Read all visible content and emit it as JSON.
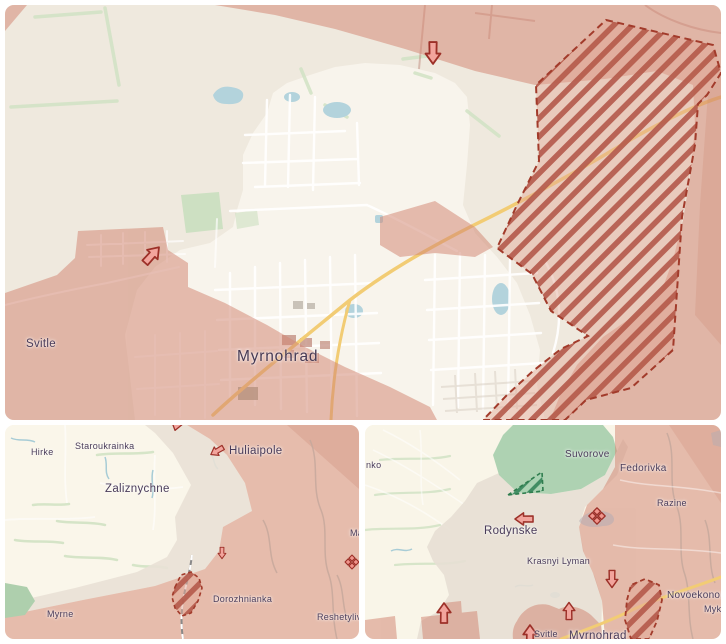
{
  "colors": {
    "map_background": "#efe9de",
    "settlement_area": "#f8f4ec",
    "occupied_fill": "#e2b0a0",
    "assault_hatch_stripe": "#b4594a",
    "assault_hatch_border": "#a23b2b",
    "counterattack_hatch_green": "#35855a",
    "forest_green": "#aed2b2",
    "water_blue": "#b3d3dc",
    "major_road_yellow": "#f2cc74",
    "label_text": "#4a3c5a",
    "marker_fill": "#f2a49c",
    "marker_outline": "#9c3028"
  },
  "icons": {
    "advance-arrow-icon": "red outlined directional assault arrow",
    "clash-diamond-icon": "red four-diamond clash marker"
  },
  "panels": {
    "top": {
      "labels": [
        {
          "text": "Svitle"
        },
        {
          "text": "Myrnohrad"
        }
      ]
    },
    "bottom_left": {
      "labels": [
        {
          "text": "Hirke"
        },
        {
          "text": "Staroukrainka"
        },
        {
          "text": "Zaliznychne"
        },
        {
          "text": "Huliaipole"
        },
        {
          "text": "Dorozhnianka"
        },
        {
          "text": "Reshetylivske"
        },
        {
          "text": "Myrne"
        },
        {
          "text": "Ma"
        }
      ]
    },
    "bottom_right": {
      "labels": [
        {
          "text": "nko"
        },
        {
          "text": "Suvorove"
        },
        {
          "text": "Fedorivka"
        },
        {
          "text": "Razine"
        },
        {
          "text": "Rodynske"
        },
        {
          "text": "Krasnyi Lyman"
        },
        {
          "text": "Novoekonomich"
        },
        {
          "text": "Mykola"
        },
        {
          "text": "Svitle"
        },
        {
          "text": "Myrnohrad"
        }
      ]
    }
  }
}
